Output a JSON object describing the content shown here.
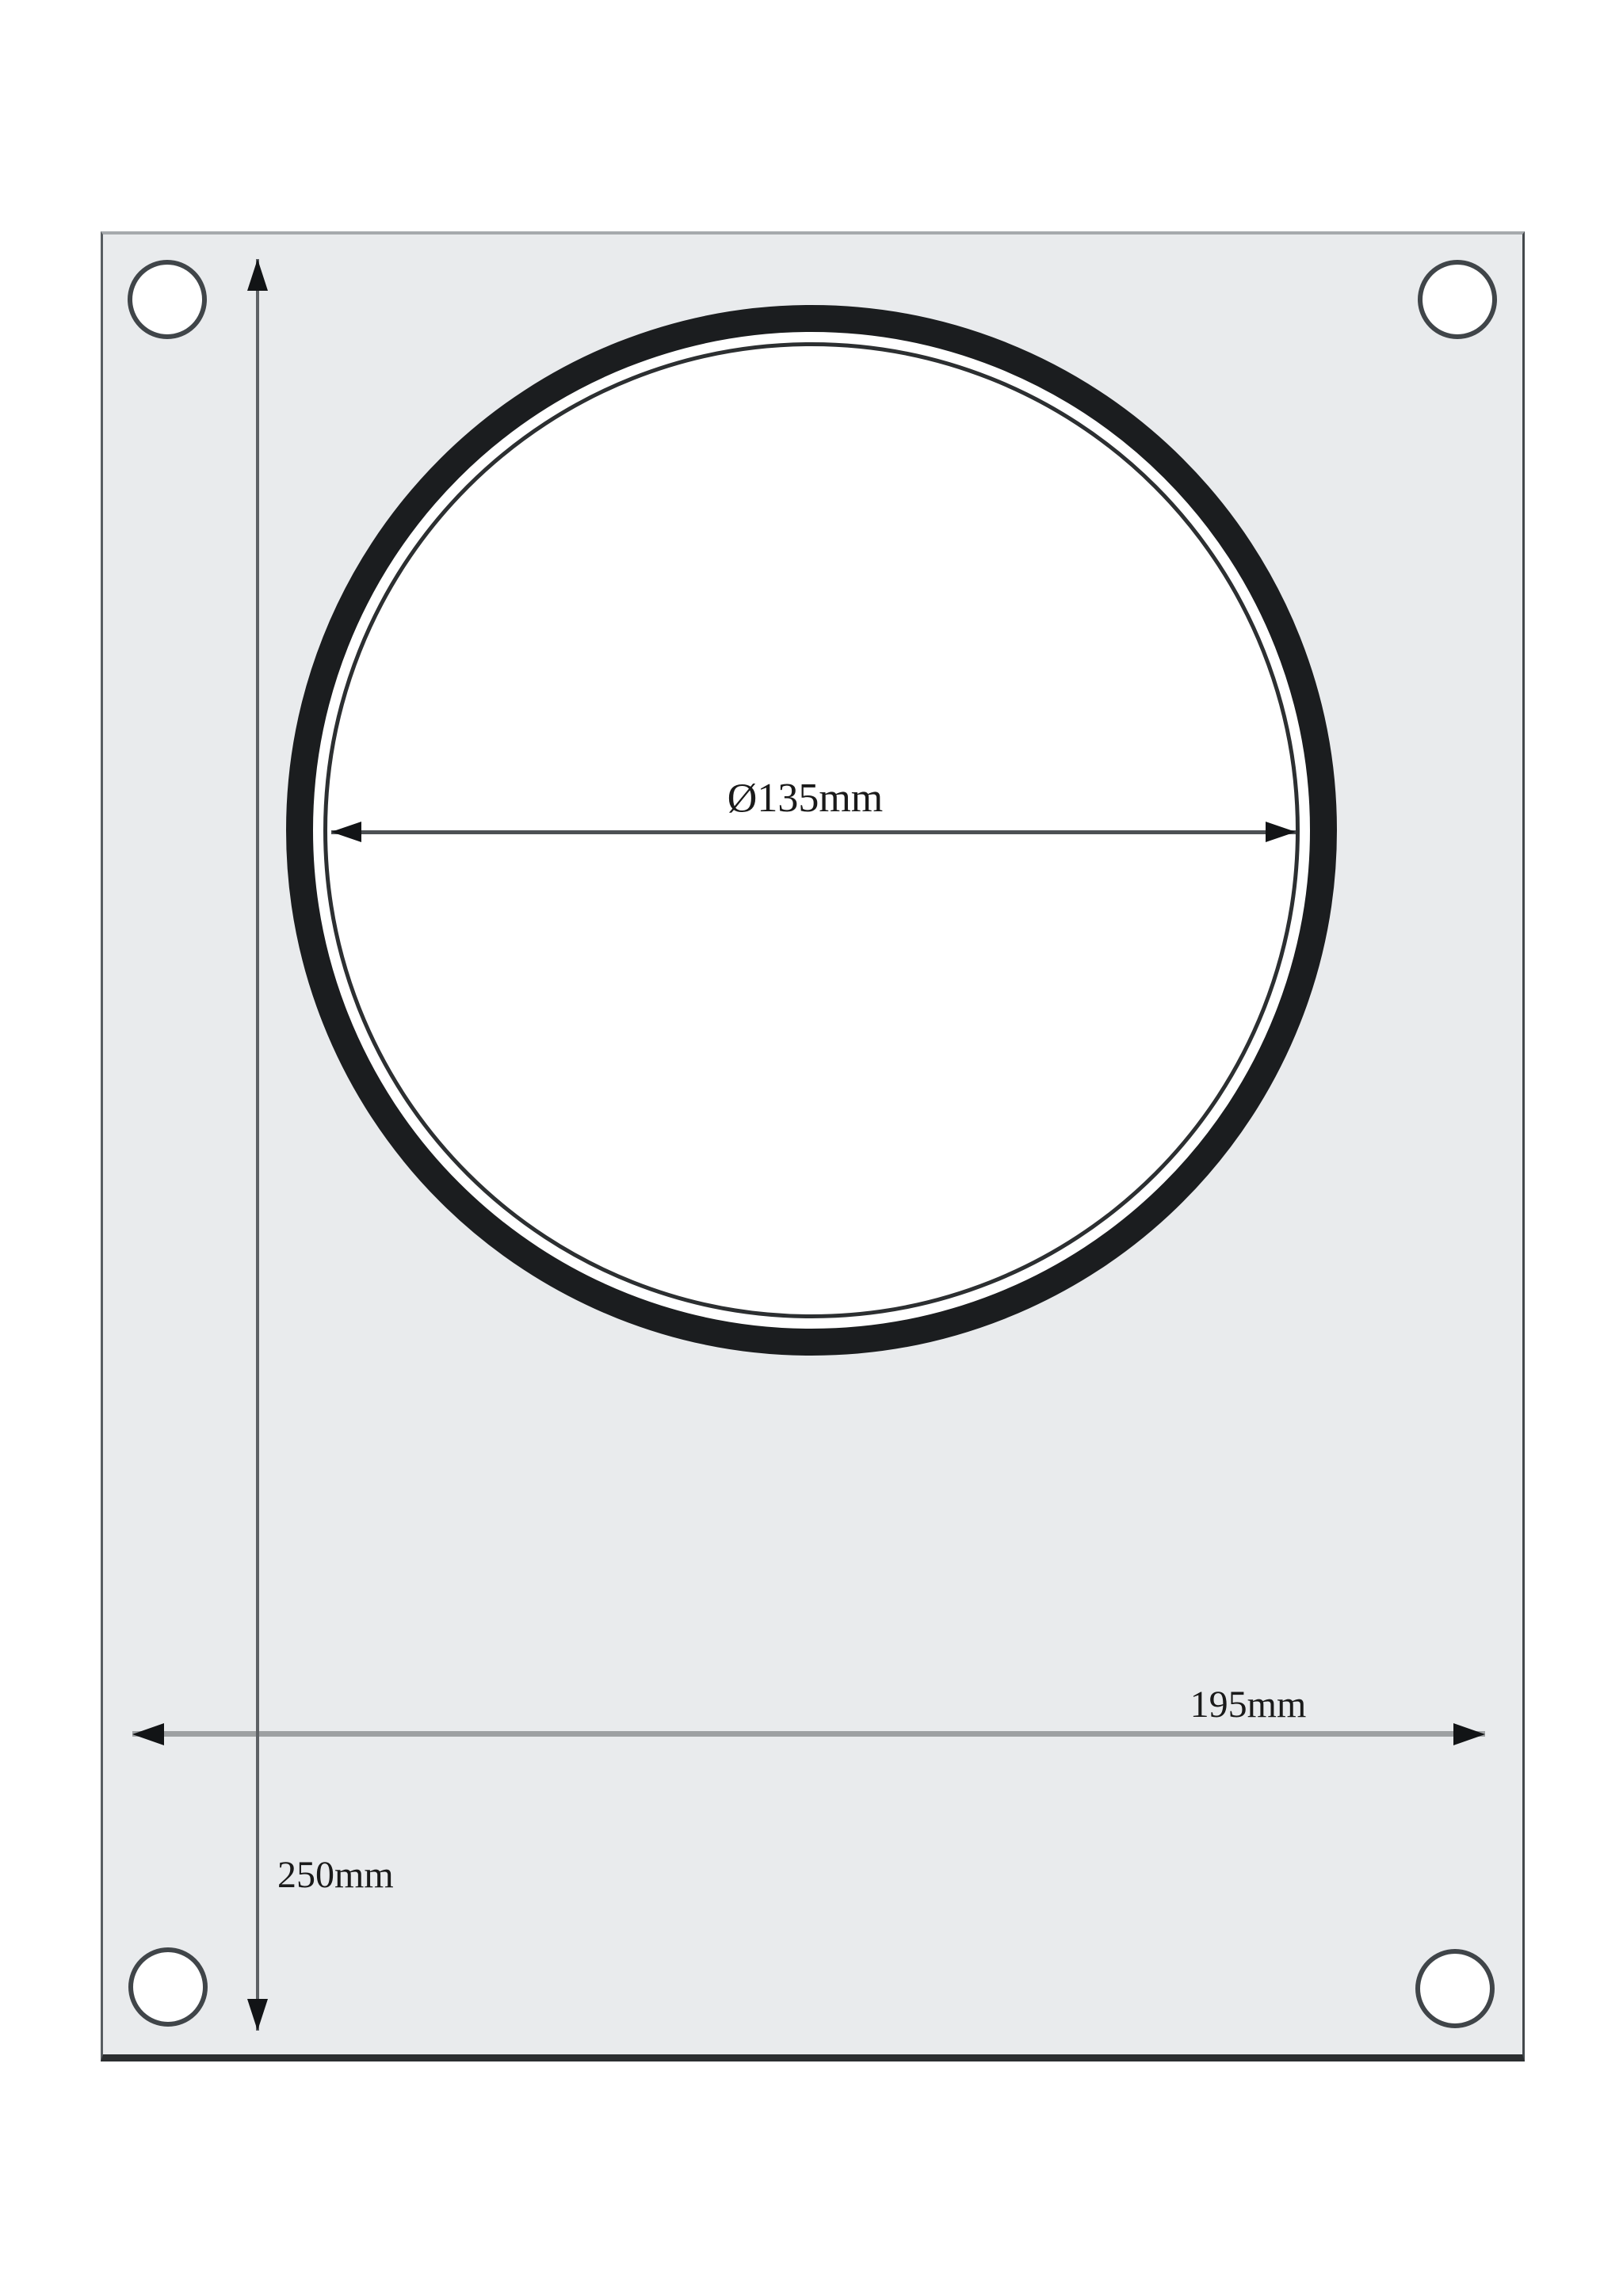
{
  "drawing": {
    "description": "technical-drawing-of-sealing-machine-matrix-plate",
    "plate": {
      "shape": "rectangle",
      "fill": "#e9ebed",
      "corner_hole_count": 4,
      "width_label": "195mm",
      "height_label": "250mm"
    },
    "seal_ring": {
      "shape": "double-circle",
      "stroke": "#1b1d1f",
      "diameter_label": "Ø135mm"
    },
    "dimensions": {
      "hole_diameter": {
        "label": "Ø135mm",
        "orientation": "horizontal"
      },
      "plate_width": {
        "label": "195mm",
        "orientation": "horizontal"
      },
      "plate_height": {
        "label": "250mm",
        "orientation": "vertical"
      }
    },
    "colors": {
      "background": "#ffffff",
      "plate_fill": "#e9ebed",
      "ring_stroke": "#1b1d1f",
      "diameter_line": "#4d5154",
      "width_line": "#9da0a2",
      "height_line": "#5d6165",
      "arrowhead": "#121416",
      "text": "#1a1a1a"
    }
  }
}
